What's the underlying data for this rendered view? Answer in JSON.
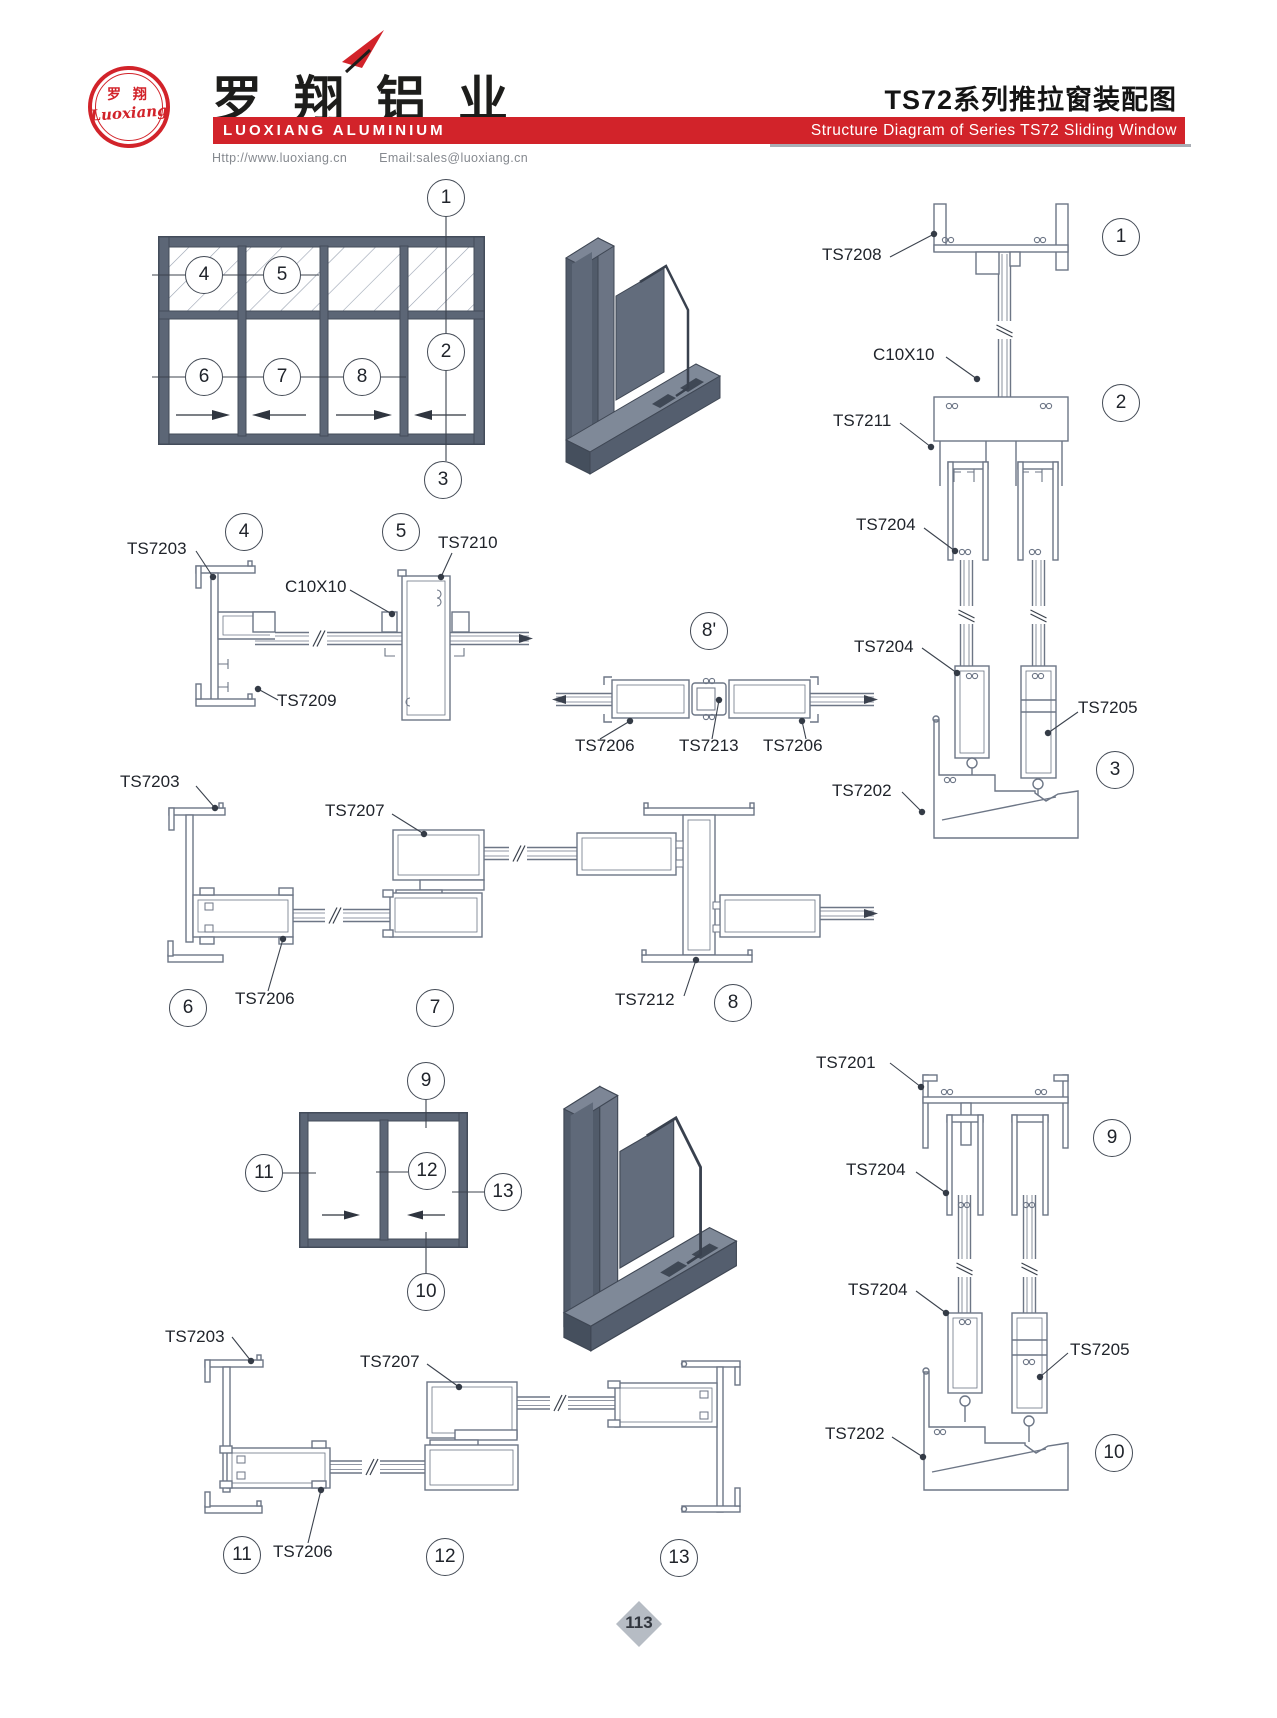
{
  "header": {
    "logo_cn": "罗 翔",
    "logo_script": "Luoxiang",
    "company_cn": "罗翔铝业",
    "company_en": "LUOXIANG ALUMINIUM",
    "title_cn": "TS72系列推拉窗装配图",
    "title_en": "Structure Diagram of Series TS72 Sliding Window",
    "website": "Http://www.luoxiang.cn",
    "email": "Email:sales@luoxiang.cn",
    "brand_red": "#d2232a"
  },
  "footer": {
    "page_number": "113"
  },
  "callouts": [
    {
      "n": "1",
      "x": 446,
      "y": 198
    },
    {
      "n": "2",
      "x": 446,
      "y": 352
    },
    {
      "n": "3",
      "x": 443,
      "y": 480
    },
    {
      "n": "4",
      "x": 204,
      "y": 275
    },
    {
      "n": "5",
      "x": 282,
      "y": 275
    },
    {
      "n": "6",
      "x": 204,
      "y": 377
    },
    {
      "n": "7",
      "x": 282,
      "y": 377
    },
    {
      "n": "8",
      "x": 362,
      "y": 377
    },
    {
      "n": "1",
      "x": 1121,
      "y": 237
    },
    {
      "n": "2",
      "x": 1121,
      "y": 403
    },
    {
      "n": "3",
      "x": 1115,
      "y": 770
    },
    {
      "n": "4",
      "x": 244,
      "y": 532
    },
    {
      "n": "5",
      "x": 401,
      "y": 532
    },
    {
      "n": "8'",
      "x": 709,
      "y": 631
    },
    {
      "n": "6",
      "x": 188,
      "y": 1008
    },
    {
      "n": "7",
      "x": 435,
      "y": 1008
    },
    {
      "n": "8",
      "x": 733,
      "y": 1003
    },
    {
      "n": "9",
      "x": 426,
      "y": 1081
    },
    {
      "n": "10",
      "x": 426,
      "y": 1292
    },
    {
      "n": "11",
      "x": 264,
      "y": 1173
    },
    {
      "n": "12",
      "x": 427,
      "y": 1171
    },
    {
      "n": "13",
      "x": 503,
      "y": 1192
    },
    {
      "n": "9",
      "x": 1112,
      "y": 1138
    },
    {
      "n": "10",
      "x": 1114,
      "y": 1453
    },
    {
      "n": "11",
      "x": 242,
      "y": 1555
    },
    {
      "n": "12",
      "x": 445,
      "y": 1557
    },
    {
      "n": "13",
      "x": 679,
      "y": 1558
    }
  ],
  "part_labels": [
    {
      "text": "TS7208",
      "x": 822,
      "y": 246
    },
    {
      "text": "C10X10",
      "x": 873,
      "y": 346
    },
    {
      "text": "TS7211",
      "x": 833,
      "y": 412
    },
    {
      "text": "TS7204",
      "x": 856,
      "y": 516
    },
    {
      "text": "TS7204",
      "x": 854,
      "y": 638
    },
    {
      "text": "TS7205",
      "x": 1078,
      "y": 699
    },
    {
      "text": "TS7202",
      "x": 832,
      "y": 782
    },
    {
      "text": "TS7203",
      "x": 127,
      "y": 540
    },
    {
      "text": "TS7210",
      "x": 438,
      "y": 534
    },
    {
      "text": "C10X10",
      "x": 285,
      "y": 578
    },
    {
      "text": "TS7209",
      "x": 277,
      "y": 692
    },
    {
      "text": "TS7206",
      "x": 575,
      "y": 737
    },
    {
      "text": "TS7213",
      "x": 679,
      "y": 737
    },
    {
      "text": "TS7206",
      "x": 763,
      "y": 737
    },
    {
      "text": "TS7203",
      "x": 120,
      "y": 773
    },
    {
      "text": "TS7207",
      "x": 325,
      "y": 802
    },
    {
      "text": "TS7206",
      "x": 235,
      "y": 990
    },
    {
      "text": "TS7212",
      "x": 615,
      "y": 991
    },
    {
      "text": "TS7201",
      "x": 816,
      "y": 1054
    },
    {
      "text": "TS7204",
      "x": 846,
      "y": 1161
    },
    {
      "text": "TS7204",
      "x": 848,
      "y": 1281
    },
    {
      "text": "TS7205",
      "x": 1070,
      "y": 1341
    },
    {
      "text": "TS7202",
      "x": 825,
      "y": 1425
    },
    {
      "text": "TS7203",
      "x": 165,
      "y": 1328
    },
    {
      "text": "TS7207",
      "x": 360,
      "y": 1353
    },
    {
      "text": "TS7206",
      "x": 273,
      "y": 1543
    }
  ]
}
